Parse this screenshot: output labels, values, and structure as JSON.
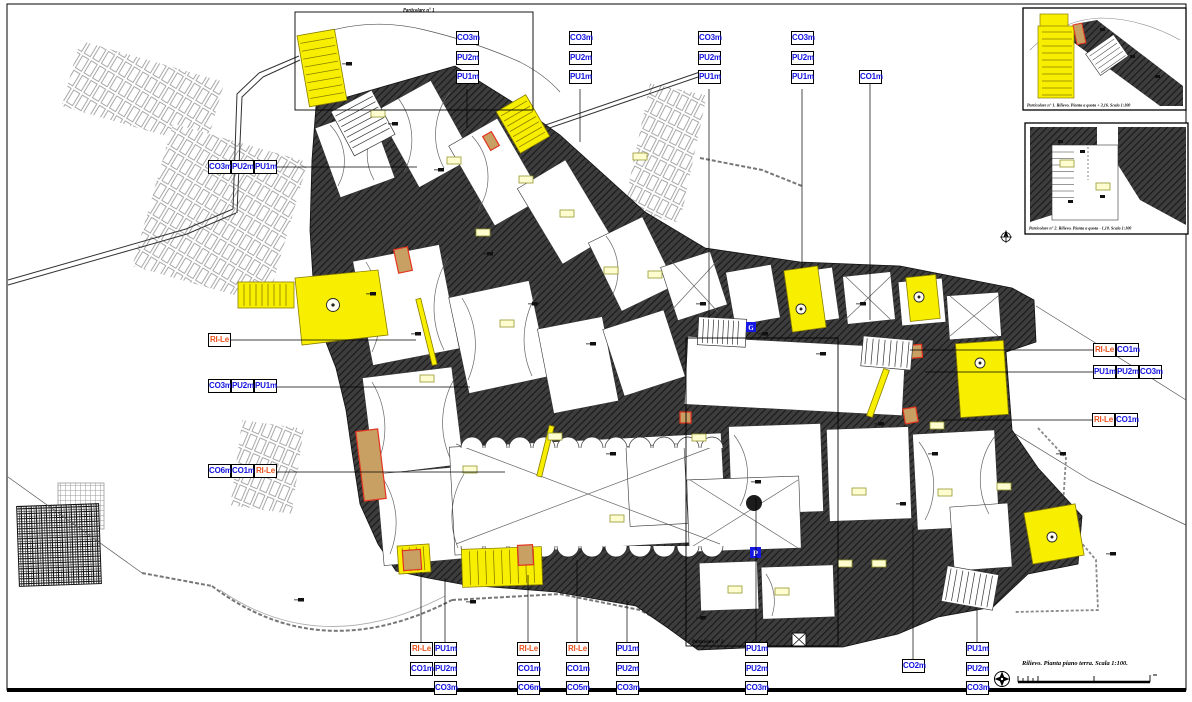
{
  "sheet": {
    "captions": {
      "detail_frame_1": "Particolare n° 1",
      "detail_frame_2": "Particolare n° 2",
      "inset_1": "Particolare n° 1. Rilievo. Pianta a quota + 3,16. Scala 1:100",
      "inset_2": "Particolare n° 2. Rilievo. Pianta a quota - 1,10. Scala 1:100",
      "main": "Rilievo. Pianta piano terra. Scala 1:100."
    },
    "icons": {
      "parking_icon_label": "P",
      "utility_icon_label": "G"
    },
    "colors": {
      "wall": "#3d3d3d",
      "highlight_yellow": "#f8ef00",
      "label_blue": "#1414e0",
      "label_orange": "#e8531f",
      "opening_tan": "#c9a063",
      "opening_red": "#e2341f"
    },
    "labels": {
      "top_col_1": [
        "CO3m",
        "PU2m",
        "PU1m"
      ],
      "top_col_2": [
        "CO3m",
        "PU2m",
        "PU1m"
      ],
      "top_col_3": [
        "CO3m",
        "PU2m",
        "PU1m"
      ],
      "top_col_4": [
        "CO3m",
        "PU2m",
        "PU1m"
      ],
      "top_col_5": [
        "CO1m"
      ],
      "left_row_1": [
        "CO3m",
        "PU2m",
        "PU1m"
      ],
      "left_row_2": [
        "RI-Le"
      ],
      "left_row_3": [
        "CO3m",
        "PU2m",
        "PU1m"
      ],
      "left_row_4": [
        "CO6m",
        "CO1m",
        "RI-Le"
      ],
      "right_row_1": [
        "RI-Le",
        "CO1m"
      ],
      "right_row_2": [
        "PU1m",
        "PU2m",
        "CO3m"
      ],
      "right_row_3": [
        "RI-Le",
        "CO1m"
      ],
      "bottom_col_1": [
        "RI-Le",
        "CO1m"
      ],
      "bottom_col_2": [
        "PU1m",
        "PU2m",
        "CO3m"
      ],
      "bottom_col_3": [
        "RI-Le",
        "CO1m",
        "CO6m"
      ],
      "bottom_col_4": [
        "RI-Le",
        "CO1m",
        "CO5m"
      ],
      "bottom_col_5": [
        "PU1m",
        "PU2m",
        "CO3m"
      ],
      "bottom_col_6": [
        "PU1m",
        "PU2m",
        "CO3m"
      ],
      "bottom_col_7": [
        "CO2m"
      ],
      "bottom_col_8": [
        "PU1m",
        "PU2m",
        "CO3m"
      ]
    }
  }
}
